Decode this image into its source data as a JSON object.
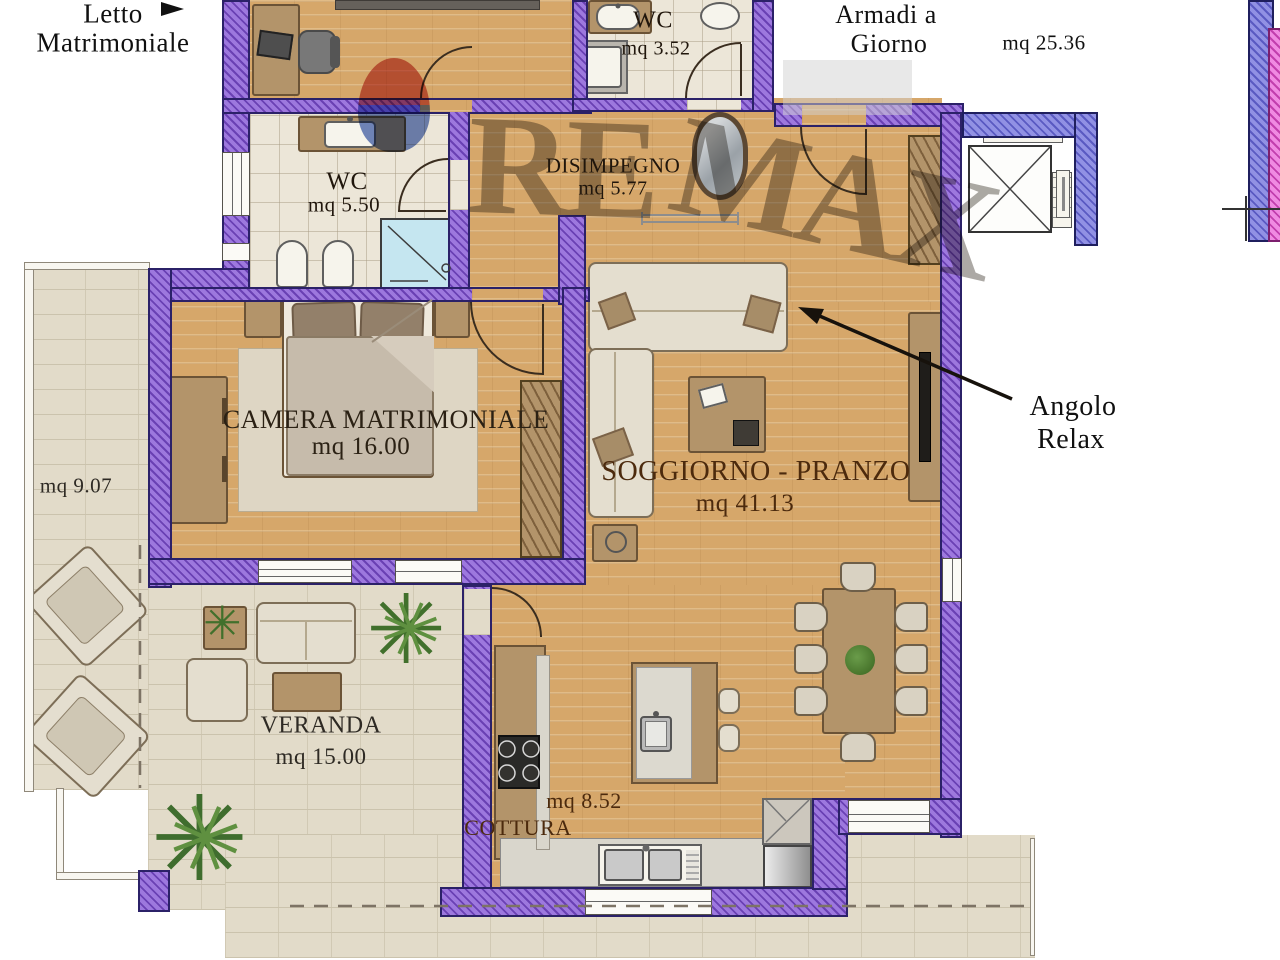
{
  "watermark": {
    "left": "RE",
    "right": "MAX"
  },
  "annotations": {
    "letto": {
      "line1": "Letto",
      "line2": "Matrimoniale"
    },
    "armadi": {
      "line1": "Armadi a",
      "line2": "Giorno",
      "area": "mq 25.36"
    },
    "angolo": {
      "line1": "Angolo",
      "line2": "Relax"
    },
    "terrace_area": "mq 9.07"
  },
  "rooms": {
    "wc_top": {
      "name": "WC",
      "area": "mq 3.52"
    },
    "wc_main": {
      "name": "WC",
      "area": "mq 5.50"
    },
    "disimpegno": {
      "name": "DISIMPEGNO",
      "area": "mq 5.77"
    },
    "camera": {
      "name": "CAMERA MATRIMONIALE",
      "area": "mq 16.00"
    },
    "soggiorno": {
      "name": "SOGGIORNO - PRANZO",
      "area": "mq 41.13"
    },
    "veranda": {
      "name": "VERANDA",
      "area": "mq 15.00"
    },
    "cottura": {
      "name": "COTTURA",
      "area": "mq 8.52"
    }
  },
  "colors": {
    "wall_light": "#9d78de",
    "wall_dark": "#6a41b4",
    "wall_blue_light": "#9191e4",
    "wall_blue_dark": "#5a5ac2",
    "wall_pink_light": "#f08ae2",
    "wall_pink_dark": "#c23fae",
    "floor_wood": "#d6a76a",
    "floor_tile": "#ece6d8",
    "terrace": "#e2dbc9",
    "shower": "#c5e6f0",
    "watermark_red": "#c4372f",
    "watermark_blue": "#2f4fa8"
  }
}
